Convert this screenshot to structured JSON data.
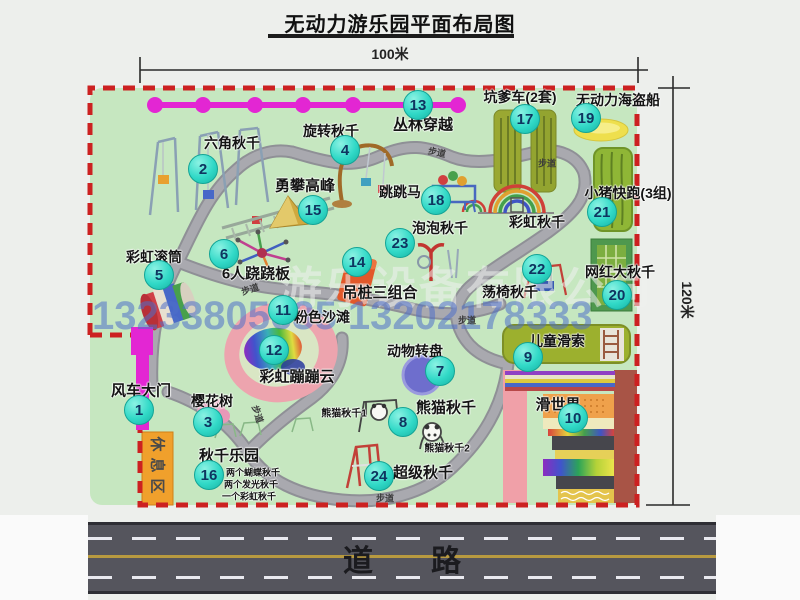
{
  "title": "无动力游乐园平面布局图",
  "dimensions": {
    "width_label": "100米",
    "height_label": "120米"
  },
  "road": {
    "label": "道路"
  },
  "rest_area": {
    "label": "休息区"
  },
  "path_label": "步道",
  "watermark": {
    "company": "游乐设备有限公司",
    "phone": "13233805635 13202178333"
  },
  "colors": {
    "park_green": "#c6e7c0",
    "border_red": "#cc2121",
    "zipline_magenta": "#e326d3",
    "badge_cyan": "#2cd6c4",
    "road_gray": "#55555d",
    "rest_area_orange": "#f0a02c"
  },
  "attractions": [
    {
      "num": "1",
      "name": "风车大门"
    },
    {
      "num": "2",
      "name": "六角秋千"
    },
    {
      "num": "3",
      "name": "樱花树"
    },
    {
      "num": "4",
      "name": "旋转秋千"
    },
    {
      "num": "5",
      "name": "彩虹滚筒"
    },
    {
      "num": "6",
      "name": "6人跷跷板"
    },
    {
      "num": "7",
      "name": "动物转盘"
    },
    {
      "num": "8",
      "name": "熊猫秋千",
      "sub": [
        "熊猫秋千1",
        "熊猫秋千2"
      ]
    },
    {
      "num": "9",
      "name": "儿童滑索"
    },
    {
      "num": "10",
      "name": "滑世界"
    },
    {
      "num": "11",
      "name": "粉色沙滩"
    },
    {
      "num": "12",
      "name": "彩虹蹦蹦云"
    },
    {
      "num": "13",
      "name": "丛林穿越"
    },
    {
      "num": "14",
      "name": "吊桩三组合"
    },
    {
      "num": "15",
      "name": "勇攀高峰"
    },
    {
      "num": "16",
      "name": "秋千乐园",
      "sub": [
        "两个蝴蝶秋千",
        "两个发光秋千",
        "一个彩虹秋千"
      ]
    },
    {
      "num": "17",
      "name": "坑爹车(2套)"
    },
    {
      "num": "18",
      "name": "跳跳马"
    },
    {
      "num": "19",
      "name": "无动力海盗船"
    },
    {
      "num": "20",
      "name": "网红大秋千"
    },
    {
      "num": "21",
      "name": "小猪快跑(3组)"
    },
    {
      "num": "22",
      "name": "荡椅秋千"
    },
    {
      "num": "23",
      "name": "泡泡秋千"
    },
    {
      "num": "24",
      "name": "超级秋千"
    },
    {
      "num": "",
      "name": "彩虹秋千"
    }
  ]
}
